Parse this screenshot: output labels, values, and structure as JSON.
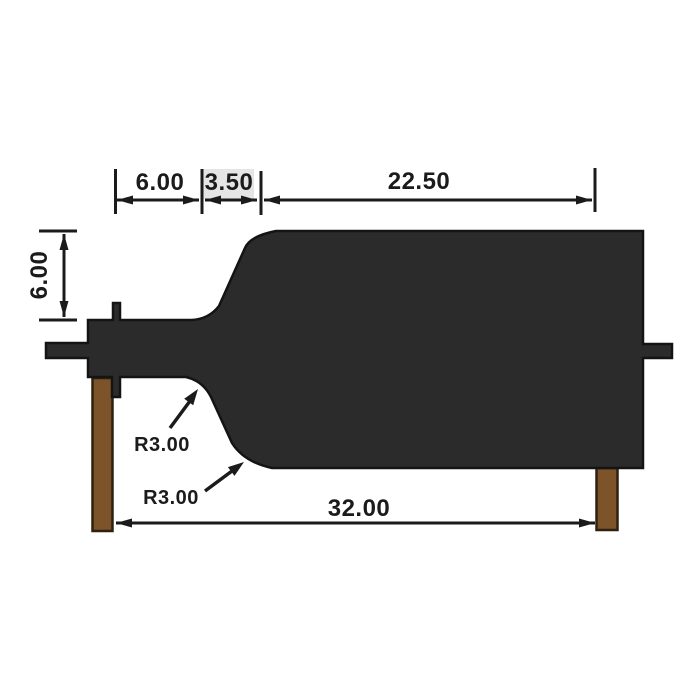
{
  "drawing": {
    "type": "technical-dimension-drawing",
    "colors": {
      "background": "#ffffff",
      "part_fill": "#2b2b2b",
      "part_outline": "#141414",
      "leg_fill": "#7d5329",
      "leg_outline": "#2f2011",
      "dimension_color": "#1b1b1b",
      "label_highlight": "#e5e5e5"
    },
    "dimensions": {
      "top_left": "6.00",
      "top_middle": "3.50",
      "top_right": "22.50",
      "left_height": "6.00",
      "bottom_length": "32.00",
      "fillet_upper": "R3.00",
      "fillet_lower": "R3.00"
    }
  }
}
